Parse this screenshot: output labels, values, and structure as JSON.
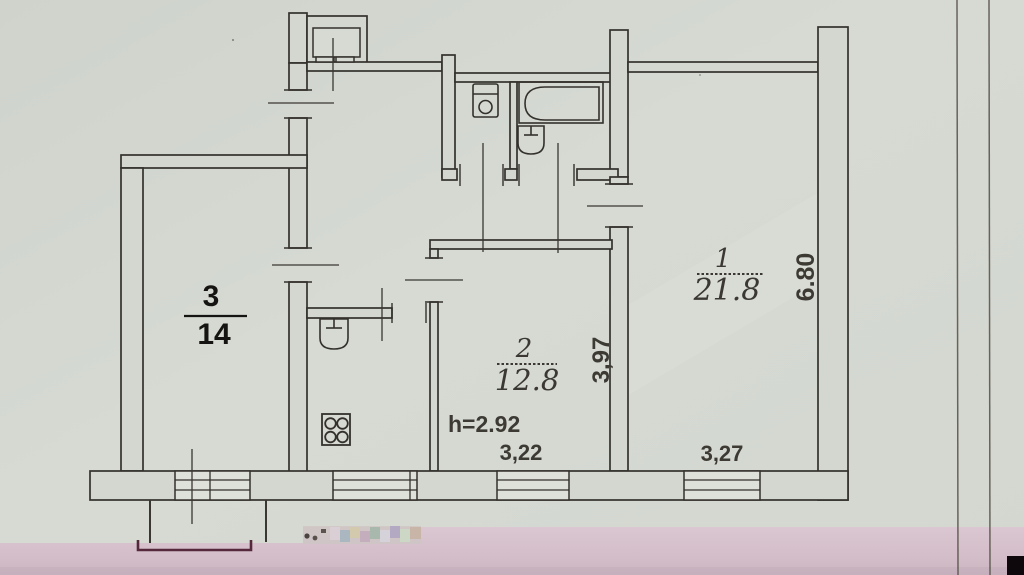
{
  "floor_plan": {
    "rooms": [
      {
        "id": "room-1",
        "number": "1",
        "area": "21.8"
      },
      {
        "id": "room-2",
        "number": "2",
        "area": "12.8"
      },
      {
        "id": "room-3",
        "number": "3",
        "area": "14"
      }
    ],
    "dimensions": {
      "room1_depth": "6.80",
      "room1_width": "3,27",
      "room2_depth": "3,97",
      "room2_width": "3,22",
      "ceiling_height": "h=2.92"
    },
    "fixtures": [
      {
        "icon": "toilet-icon"
      },
      {
        "icon": "bathtub-icon"
      },
      {
        "icon": "washbasin-icon"
      },
      {
        "icon": "kitchen-sink-icon"
      },
      {
        "icon": "stove-icon"
      },
      {
        "icon": "closet-icon"
      }
    ],
    "colors": {
      "paper": "#d5d9d2",
      "ink": "#34312c",
      "pink_band": "#d6c2cd",
      "balcony_outline": "#55293b",
      "corner_black": "#0e080d"
    }
  }
}
